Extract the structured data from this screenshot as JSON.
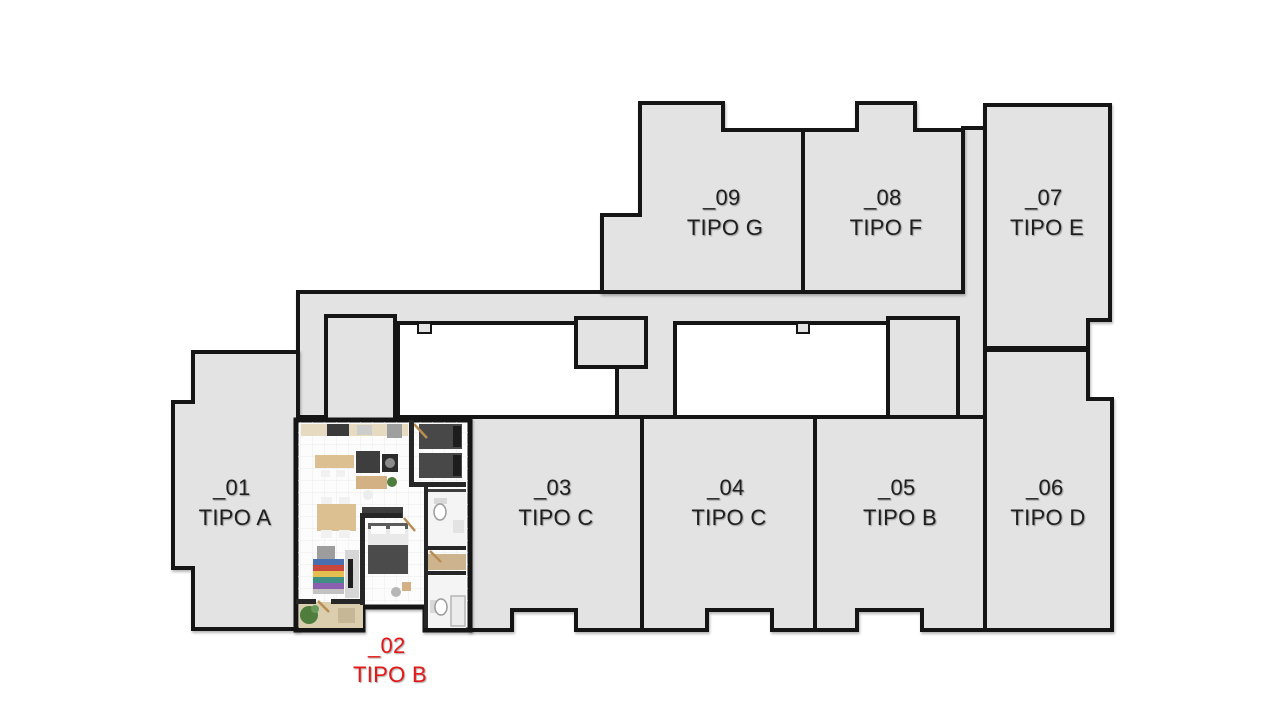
{
  "palette": {
    "background": "#ffffff",
    "unit_fill": "#e3e3e3",
    "wall": "#151515",
    "label": "#1f1f1f",
    "highlight": "#e51717",
    "floor": "#fcfcfc",
    "interior_wall": "#262626",
    "courtyard": "#ffffff"
  },
  "units": [
    {
      "id": "_01",
      "tipo": "TIPO A",
      "selected": false,
      "points": "193,352 298,352 298,629 193,629 193,568 173,568 173,402 193,402"
    },
    {
      "id": "_02",
      "tipo": "TIPO B",
      "selected": true,
      "points": null
    },
    {
      "id": "_03",
      "tipo": "TIPO C",
      "selected": false,
      "points": "470,417 642,417 642,630 576,630 576,610 512,610 512,630 470,630"
    },
    {
      "id": "_04",
      "tipo": "TIPO C",
      "selected": false,
      "points": "642,417 815,417 815,630 772,630 772,610 707,610 707,630 642,630"
    },
    {
      "id": "_05",
      "tipo": "TIPO B",
      "selected": false,
      "points": "815,417 985,417 985,630 922,630 922,610 857,610 857,630 815,630"
    },
    {
      "id": "_06",
      "tipo": "TIPO D",
      "selected": false,
      "points": "985,350 1088,350 1088,399 1112,399 1112,630 985,630"
    },
    {
      "id": "_07",
      "tipo": "TIPO E",
      "selected": false,
      "points": "985,105 1110,105 1110,320 1088,320 1088,348 985,348"
    },
    {
      "id": "_08",
      "tipo": "TIPO F",
      "selected": false,
      "points": "803,130 857,130 857,103 915,103 915,130 963,130 963,292 803,292"
    },
    {
      "id": "_09",
      "tipo": "TIPO G",
      "selected": false,
      "points": "640,103 723,103 723,130 803,130 803,292 602,292 602,215 640,215"
    }
  ],
  "common_areas": [
    {
      "name": "corridor",
      "white": false,
      "sw": 4,
      "points": "298,292 963,292 963,128 985,128 985,417 665,417 665,433 617,433 617,417 298,417"
    },
    {
      "name": "core-left",
      "white": false,
      "sw": 4,
      "points": "326,316 395,316 395,420 326,420"
    },
    {
      "name": "courtyard-left",
      "white": true,
      "sw": 4,
      "points": "398,323 576,323 576,367 617,367 617,417 398,417"
    },
    {
      "name": "courtyard-right",
      "white": true,
      "sw": 4,
      "points": "675,323 888,323 888,417 675,417"
    },
    {
      "name": "core-mid",
      "white": false,
      "sw": 4,
      "points": "576,318 646,318 646,367 576,367"
    },
    {
      "name": "core-right",
      "white": false,
      "sw": 4,
      "points": "888,318 958,318 958,426 888,426"
    },
    {
      "name": "courtyard-left-stub",
      "white": false,
      "sw": 2,
      "points": "418,323 431,323 431,333 418,333"
    },
    {
      "name": "courtyard-right-stub",
      "white": false,
      "sw": 2,
      "points": "797,323 809,323 809,333 797,333"
    }
  ],
  "unit_detail": {
    "unit": "_02",
    "outline": "296,420 470,420 470,630 425,630 425,607 363,607 363,630 296,630",
    "furniture": [
      {
        "n": "balcony-floor",
        "t": "rect",
        "x": 299,
        "y": 602,
        "w": 64,
        "h": 26,
        "f": "#dbceae"
      },
      {
        "n": "balcony-plant",
        "t": "circle",
        "cx": 309,
        "cy": 615,
        "r": 9,
        "f": "#4e7d3e"
      },
      {
        "n": "balcony-plant-top",
        "t": "circle",
        "cx": 315,
        "cy": 609,
        "r": 4,
        "f": "#6a9a5b"
      },
      {
        "n": "balcony-mat",
        "t": "rect",
        "x": 338,
        "y": 608,
        "w": 17,
        "h": 15,
        "f": "#c6b897"
      },
      {
        "n": "kitchen-counter",
        "t": "rect",
        "x": 301,
        "y": 424,
        "w": 107,
        "h": 12,
        "f": "#e6dac0"
      },
      {
        "n": "stove",
        "t": "rect",
        "x": 327,
        "y": 424,
        "w": 22,
        "h": 12,
        "f": "#3a3a3a"
      },
      {
        "n": "kitchen-sink",
        "t": "rect",
        "x": 357,
        "y": 425,
        "w": 15,
        "h": 10,
        "f": "#cdcdcd"
      },
      {
        "n": "fridge",
        "t": "rect",
        "x": 387,
        "y": 424,
        "w": 15,
        "h": 14,
        "f": "#9f9f9f"
      },
      {
        "n": "island-counter",
        "t": "rect",
        "x": 315,
        "y": 455,
        "w": 39,
        "h": 13,
        "f": "#ddc092"
      },
      {
        "n": "stool-1",
        "t": "rect",
        "x": 321,
        "y": 470,
        "w": 9,
        "h": 7,
        "f": "#f1f1f1"
      },
      {
        "n": "stool-2",
        "t": "rect",
        "x": 336,
        "y": 470,
        "w": 9,
        "h": 7,
        "f": "#f1f1f1"
      },
      {
        "n": "dark-cabinet",
        "t": "rect",
        "x": 356,
        "y": 451,
        "w": 24,
        "h": 22,
        "f": "#3e3e3e"
      },
      {
        "n": "oven",
        "t": "rect",
        "x": 382,
        "y": 454,
        "w": 16,
        "h": 18,
        "f": "#2c2c2c"
      },
      {
        "n": "oven-door",
        "t": "circle",
        "cx": 390,
        "cy": 463,
        "r": 5,
        "f": "#8b8b8b"
      },
      {
        "n": "desk",
        "t": "rect",
        "x": 356,
        "y": 476,
        "w": 31,
        "h": 13,
        "f": "#d3b184"
      },
      {
        "n": "desk-chair",
        "t": "circle",
        "cx": 368,
        "cy": 495,
        "r": 5,
        "f": "#ededed"
      },
      {
        "n": "desk-plant",
        "t": "circle",
        "cx": 392,
        "cy": 482,
        "r": 5,
        "f": "#4e7d3e"
      },
      {
        "n": "twin-bed-1",
        "t": "rect",
        "x": 419,
        "y": 424,
        "w": 43,
        "h": 25,
        "f": "#484848"
      },
      {
        "n": "twin-bed-1-pillow",
        "t": "rect",
        "x": 453,
        "y": 426,
        "w": 8,
        "h": 21,
        "f": "#1d1d1d"
      },
      {
        "n": "twin-bed-2",
        "t": "rect",
        "x": 419,
        "y": 453,
        "w": 43,
        "h": 25,
        "f": "#484848"
      },
      {
        "n": "twin-bed-2-pillow",
        "t": "rect",
        "x": 453,
        "y": 455,
        "w": 8,
        "h": 21,
        "f": "#1d1d1d"
      },
      {
        "n": "wardrobe",
        "t": "rect",
        "x": 426,
        "y": 489,
        "w": 40,
        "h": 8,
        "f": "#3e3e3e"
      },
      {
        "n": "dining-chair-1",
        "t": "rect",
        "x": 321,
        "y": 497,
        "w": 11,
        "h": 8,
        "f": "#f1f1f1"
      },
      {
        "n": "dining-chair-2",
        "t": "rect",
        "x": 339,
        "y": 497,
        "w": 11,
        "h": 8,
        "f": "#f1f1f1"
      },
      {
        "n": "dining-table",
        "t": "rect",
        "x": 317,
        "y": 504,
        "w": 39,
        "h": 27,
        "f": "#ddc092"
      },
      {
        "n": "dining-chair-3",
        "t": "rect",
        "x": 321,
        "y": 530,
        "w": 11,
        "h": 8,
        "f": "#f1f1f1"
      },
      {
        "n": "dining-chair-4",
        "t": "rect",
        "x": 339,
        "y": 530,
        "w": 11,
        "h": 8,
        "f": "#f1f1f1"
      },
      {
        "n": "sideboard",
        "t": "rect",
        "x": 362,
        "y": 507,
        "w": 41,
        "h": 11,
        "f": "#3e3e3e"
      },
      {
        "n": "bath-1-floor",
        "t": "rect",
        "x": 428,
        "y": 492,
        "w": 38,
        "h": 56,
        "f": "#f4f4f4"
      },
      {
        "n": "toilet-1-tank",
        "t": "rect",
        "x": 434,
        "y": 498,
        "w": 13,
        "h": 6,
        "f": "#d9d9d9"
      },
      {
        "n": "toilet-1",
        "t": "ellipse",
        "cx": 440,
        "cy": 512,
        "rx": 6,
        "ry": 8,
        "f": "#ffffff",
        "s": "#9b9b9b"
      },
      {
        "n": "bath-1-sink",
        "t": "rect",
        "x": 453,
        "y": 520,
        "w": 11,
        "h": 13,
        "f": "#e3e3e3"
      },
      {
        "n": "master-headboard",
        "t": "rect",
        "x": 368,
        "y": 523,
        "w": 40,
        "h": 6,
        "f": "#5b5b5b"
      },
      {
        "n": "master-bed",
        "t": "rect",
        "x": 368,
        "y": 529,
        "w": 40,
        "h": 45,
        "f": "#e9e9e9"
      },
      {
        "n": "master-pillow-1",
        "t": "rect",
        "x": 371,
        "y": 526,
        "w": 15,
        "h": 8,
        "f": "#fbfbfb"
      },
      {
        "n": "master-pillow-2",
        "t": "rect",
        "x": 390,
        "y": 526,
        "w": 15,
        "h": 8,
        "f": "#fbfbfb"
      },
      {
        "n": "master-duvet",
        "t": "rect",
        "x": 368,
        "y": 545,
        "w": 40,
        "h": 29,
        "f": "#4b4b4b"
      },
      {
        "n": "armchair",
        "t": "rect",
        "x": 317,
        "y": 546,
        "w": 18,
        "h": 13,
        "f": "#9d9d9d"
      },
      {
        "n": "rug-stripe-1",
        "t": "rect",
        "x": 313,
        "y": 559,
        "w": 31,
        "h": 6,
        "f": "#4a6fae"
      },
      {
        "n": "rug-stripe-2",
        "t": "rect",
        "x": 313,
        "y": 565,
        "w": 31,
        "h": 6,
        "f": "#c8473c"
      },
      {
        "n": "rug-stripe-3",
        "t": "rect",
        "x": 313,
        "y": 571,
        "w": 31,
        "h": 6,
        "f": "#e2bf4e"
      },
      {
        "n": "rug-stripe-4",
        "t": "rect",
        "x": 313,
        "y": 577,
        "w": 31,
        "h": 6,
        "f": "#3f8f83"
      },
      {
        "n": "rug-stripe-5",
        "t": "rect",
        "x": 313,
        "y": 583,
        "w": 31,
        "h": 6,
        "f": "#8a5fb0"
      },
      {
        "n": "rug-stripe-6",
        "t": "rect",
        "x": 313,
        "y": 589,
        "w": 31,
        "h": 5,
        "f": "#c2c2c2"
      },
      {
        "n": "tv-unit",
        "t": "rect",
        "x": 345,
        "y": 550,
        "w": 14,
        "h": 48,
        "f": "#d6d6d6"
      },
      {
        "n": "tv",
        "t": "rect",
        "x": 348,
        "y": 559,
        "w": 5,
        "h": 29,
        "f": "#1e1e1e"
      },
      {
        "n": "side-table",
        "t": "rect",
        "x": 402,
        "y": 582,
        "w": 9,
        "h": 9,
        "f": "#d3b184"
      },
      {
        "n": "pouf",
        "t": "circle",
        "cx": 396,
        "cy": 592,
        "r": 5,
        "f": "#b7b7b7"
      },
      {
        "n": "closet-shelf",
        "t": "rect",
        "x": 428,
        "y": 554,
        "w": 38,
        "h": 16,
        "f": "#cdb48e"
      },
      {
        "n": "bath-2-floor",
        "t": "rect",
        "x": 428,
        "y": 576,
        "w": 38,
        "h": 52,
        "f": "#f4f4f4"
      },
      {
        "n": "toilet-2-tank",
        "t": "rect",
        "x": 430,
        "y": 600,
        "w": 6,
        "h": 13,
        "f": "#d9d9d9"
      },
      {
        "n": "toilet-2",
        "t": "ellipse",
        "cx": 441,
        "cy": 607,
        "rx": 6,
        "ry": 8,
        "f": "#ffffff",
        "s": "#9b9b9b"
      },
      {
        "n": "shower",
        "t": "rect",
        "x": 451,
        "y": 596,
        "w": 14,
        "h": 30,
        "f": "#ebebeb",
        "s": "#b5b5b5"
      },
      {
        "n": "door-swing-entry",
        "t": "line",
        "x1": 414,
        "y1": 424,
        "x2": 427,
        "y2": 438,
        "s": "#b98c52"
      },
      {
        "n": "door-swing-master",
        "t": "line",
        "x1": 404,
        "y1": 518,
        "x2": 415,
        "y2": 531,
        "s": "#b98c52"
      },
      {
        "n": "door-swing-bath",
        "t": "line",
        "x1": 430,
        "y1": 551,
        "x2": 441,
        "y2": 562,
        "s": "#b98c52"
      },
      {
        "n": "door-swing-balcony",
        "t": "line",
        "x1": 318,
        "y1": 601,
        "x2": 329,
        "y2": 612,
        "s": "#b98c52"
      }
    ],
    "walls": [
      {
        "x": 409,
        "y": 420,
        "w": 5,
        "h": 64
      },
      {
        "x": 409,
        "y": 482,
        "w": 57,
        "h": 5
      },
      {
        "x": 424,
        "y": 487,
        "w": 4,
        "h": 141
      },
      {
        "x": 424,
        "y": 546,
        "w": 42,
        "h": 4
      },
      {
        "x": 424,
        "y": 571,
        "w": 42,
        "h": 4
      },
      {
        "x": 360,
        "y": 513,
        "w": 42,
        "h": 5
      },
      {
        "x": 360,
        "y": 513,
        "w": 5,
        "h": 92
      },
      {
        "x": 296,
        "y": 599,
        "w": 20,
        "h": 5
      },
      {
        "x": 331,
        "y": 599,
        "w": 33,
        "h": 5
      }
    ]
  }
}
